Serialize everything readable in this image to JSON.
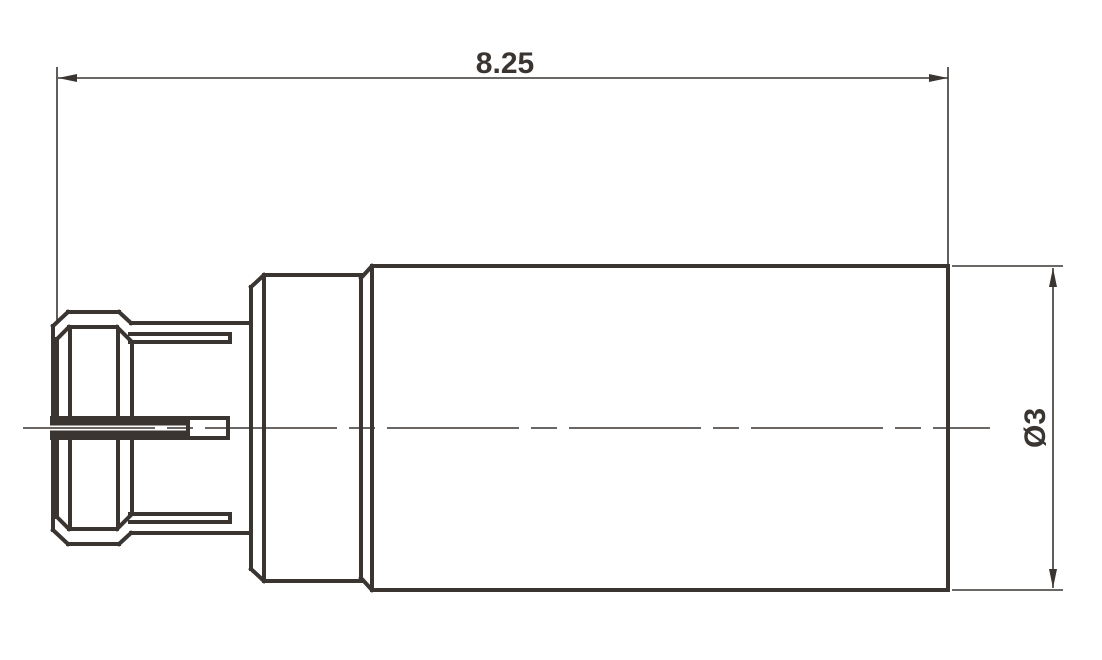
{
  "drawing": {
    "length_dimension": {
      "label": "8.25"
    },
    "diameter_dimension": {
      "label": "Ø3"
    }
  },
  "colors": {
    "line": "#3a3531",
    "background": "#ffffff"
  }
}
